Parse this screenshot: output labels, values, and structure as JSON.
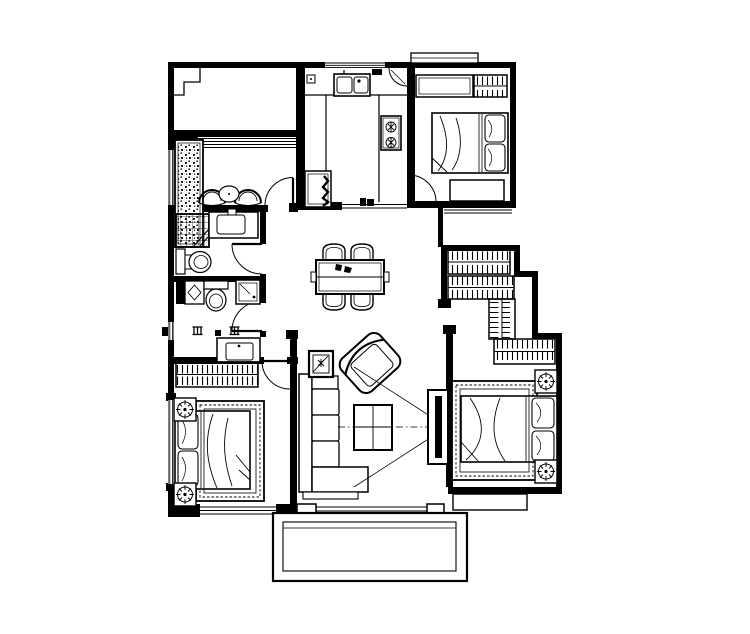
{
  "canvas": {
    "width": 750,
    "height": 634,
    "background_color": "#ffffff",
    "line_color": "#000000"
  },
  "drawing": {
    "type": "residential-floor-plan",
    "style": "monochrome CAD line drawing, top view",
    "rooms": [
      {
        "id": "terrace-top-left",
        "bbox": [
          168,
          62,
          298,
          137
        ],
        "features": [
          "stepped-corner"
        ]
      },
      {
        "id": "leisure-balcony",
        "bbox": [
          168,
          130,
          298,
          212
        ],
        "furniture": [
          "planter-box",
          "fan-chair",
          "fan-chair",
          "round-tea-table"
        ],
        "doors": [
          "swing-door"
        ]
      },
      {
        "id": "kitchen",
        "bbox": [
          296,
          62,
          415,
          210
        ],
        "furniture": [
          "double-sink",
          "counter",
          "gas-stove-2-burner",
          "refrigerator",
          "corner-shelf"
        ]
      },
      {
        "id": "bedroom-top-right",
        "bbox": [
          407,
          62,
          516,
          208
        ],
        "furniture": [
          "cabinet-row",
          "hatched-wardrobe",
          "single-bed-with-pillows",
          "desk"
        ],
        "doors": [
          "swing-door"
        ]
      },
      {
        "id": "bathroom-1",
        "bbox": [
          168,
          205,
          266,
          282
        ],
        "furniture": [
          "shower-tray",
          "wash-basin-counter",
          "toilet"
        ],
        "doors": [
          "swing-door"
        ]
      },
      {
        "id": "bathroom-2",
        "bbox": [
          168,
          276,
          266,
          335
        ],
        "furniture": [
          "washing-machine",
          "toilet",
          "side-cabinet"
        ],
        "doors": [
          "swing-door"
        ]
      },
      {
        "id": "vanity-nook",
        "bbox": [
          168,
          335,
          266,
          364
        ],
        "furniture": [
          "vanity-basin"
        ]
      },
      {
        "id": "dining-area",
        "bbox": [
          296,
          207,
          443,
          335
        ],
        "furniture": [
          "dining-table",
          "dining-chair",
          "dining-chair",
          "dining-chair",
          "dining-chair",
          "table-centerpiece"
        ]
      },
      {
        "id": "bedroom-bottom-left",
        "bbox": [
          168,
          357,
          297,
          517
        ],
        "furniture": [
          "hatched-wardrobe",
          "double-bed-with-pillows",
          "nightstand-lamp",
          "nightstand-lamp",
          "ornamental-rug"
        ],
        "windows": [
          "bottom-window",
          "left-window"
        ]
      },
      {
        "id": "living-room",
        "bbox": [
          290,
          335,
          453,
          515
        ],
        "furniture": [
          "l-shaped-sofa",
          "armchair-rotated",
          "plant-side-table",
          "coffee-table",
          "tv-panel",
          "sight-lines"
        ]
      },
      {
        "id": "master-suite",
        "bbox": [
          441,
          245,
          562,
          494
        ],
        "furniture": [
          "hatched-wardrobe-band-1",
          "hatched-wardrobe-band-2",
          "hatched-wardrobe-band-vertical",
          "hatched-wardrobe-band-3",
          "double-bed-with-pillows",
          "nightstand-lamp",
          "nightstand-lamp",
          "ornamental-rug"
        ]
      },
      {
        "id": "bottom-balcony",
        "bbox": [
          273,
          513,
          467,
          581
        ],
        "features": [
          "double-outline"
        ]
      }
    ],
    "windows": [
      {
        "id": "kitchen-top-window",
        "bbox": [
          325,
          61,
          385,
          69
        ]
      },
      {
        "id": "balcony-room-window",
        "bbox": [
          196,
          136,
          296,
          148
        ]
      },
      {
        "id": "left-wall-window-upper",
        "bbox": [
          168,
          150,
          174,
          205
        ]
      },
      {
        "id": "left-wall-window-small",
        "bbox": [
          168,
          322,
          174,
          340
        ]
      },
      {
        "id": "bedroom-left-window",
        "bbox": [
          168,
          400,
          174,
          484
        ]
      },
      {
        "id": "bedroom-bottom-window",
        "bbox": [
          198,
          505,
          278,
          516
        ]
      },
      {
        "id": "bedroom1-lower-band",
        "bbox": [
          444,
          208,
          512,
          214
        ]
      },
      {
        "id": "living-balcony-track",
        "bbox": [
          316,
          505,
          427,
          513
        ]
      }
    ],
    "doors": [
      {
        "id": "door-leisure-balcony",
        "hinge": [
          293,
          205
        ]
      },
      {
        "id": "door-bathroom-1",
        "hinge": [
          262,
          244
        ]
      },
      {
        "id": "door-bathroom-2",
        "hinge": [
          262,
          331
        ]
      },
      {
        "id": "door-bedroom-bottom-left",
        "hinge": [
          290,
          361
        ]
      },
      {
        "id": "door-bedroom-top-right",
        "hinge": [
          409,
          202
        ]
      }
    ]
  }
}
